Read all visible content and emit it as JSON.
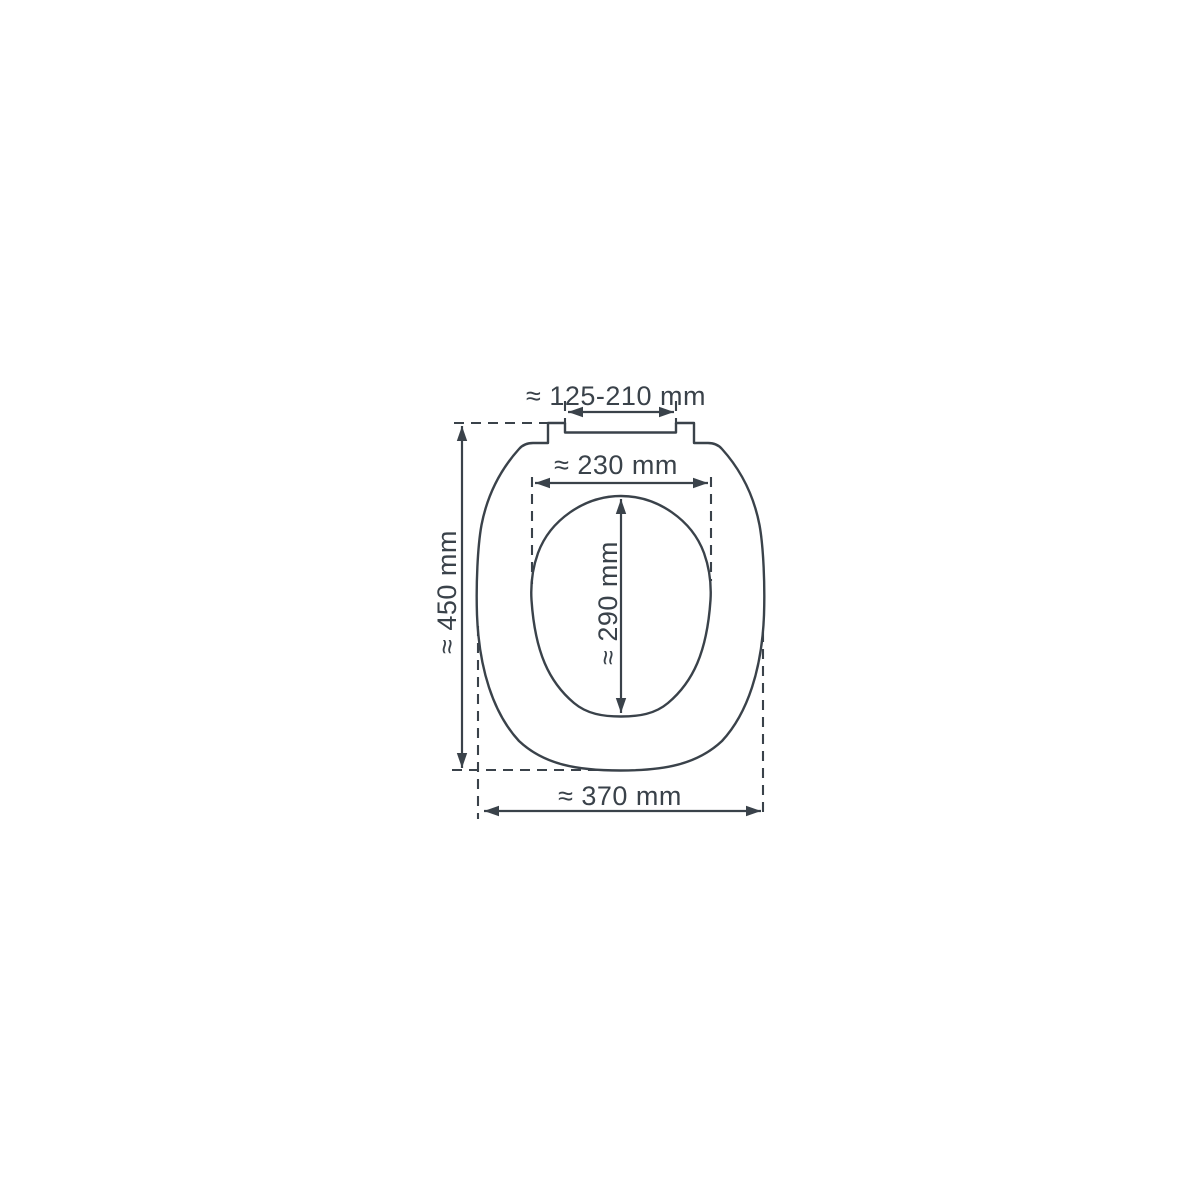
{
  "figure": {
    "description": "Technical dimension drawing of a toilet seat, top view",
    "background_color": "#ffffff",
    "line_color": "#3a424a",
    "unit": "mm",
    "dimensions": {
      "hinge_spacing": {
        "label": "≈ 125-210 mm",
        "orientation": "horizontal",
        "location": "top hinge fixing distance"
      },
      "inner_width": {
        "label": "≈ 230 mm",
        "orientation": "horizontal",
        "location": "inner opening width"
      },
      "inner_length": {
        "label": "≈ 290 mm",
        "orientation": "vertical",
        "location": "inner opening length"
      },
      "overall_length": {
        "label": "≈ 450 mm",
        "orientation": "vertical",
        "location": "overall seat length"
      },
      "overall_width": {
        "label": "≈ 370 mm",
        "orientation": "horizontal",
        "location": "overall seat width"
      }
    }
  }
}
